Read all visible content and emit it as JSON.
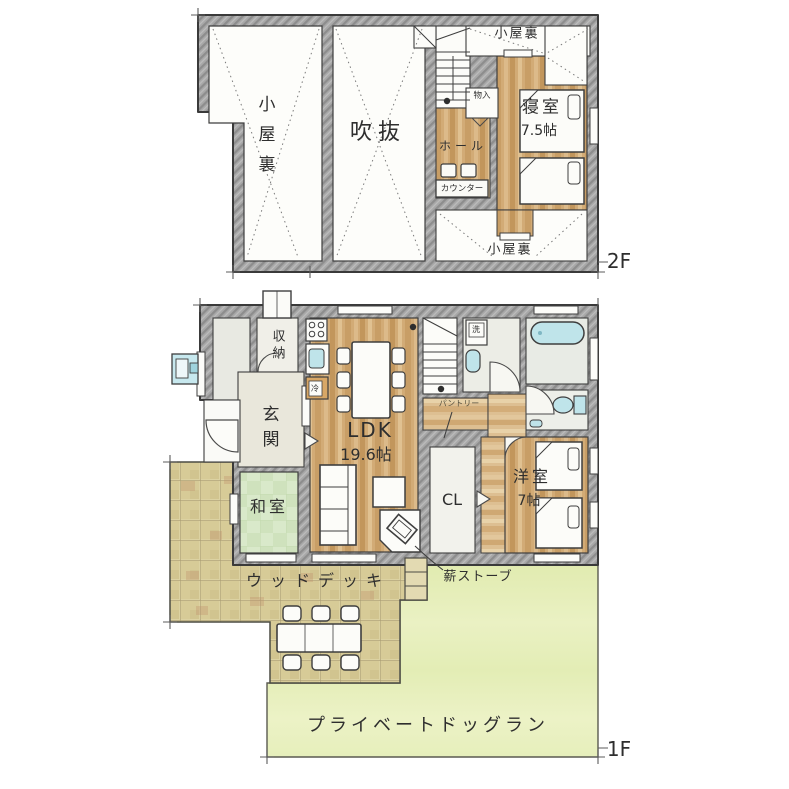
{
  "title": "2階建て住宅 間取り図",
  "colors": {
    "wall": "#a8a8a8",
    "wood_floor": "#d2ab76",
    "tatami": "#d9e9ca",
    "deck": "#dcd2a2",
    "lawn": "#e8efbe",
    "fixture_blue": "#bfe4ea",
    "line": "#3e3e3e"
  },
  "floor2": {
    "tag": "2F",
    "labels": {
      "attic_left": "小屋裏",
      "void": "吹抜",
      "attic_top": "小屋裏",
      "storage": "物入",
      "hall": "ホール",
      "counter": "カウンター",
      "bedroom": "寝室",
      "bedroom_size": "7.5帖",
      "attic_bottom": "小屋裏"
    }
  },
  "floor1": {
    "tag": "1F",
    "labels": {
      "storage": "収納",
      "entrance": "玄関",
      "japanese_room": "和室",
      "ldk": "LDK",
      "ldk_size": "19.6帖",
      "pantry": "パントリー",
      "closet": "CL",
      "western_room": "洋室",
      "western_room_size": "7帖",
      "laundry": "洗",
      "fridge": "冷"
    },
    "exterior": {
      "wood_stove": "薪ストーブ",
      "wood_deck": "ウッドデッキ",
      "dog_run": "プライベートドッグラン"
    }
  }
}
